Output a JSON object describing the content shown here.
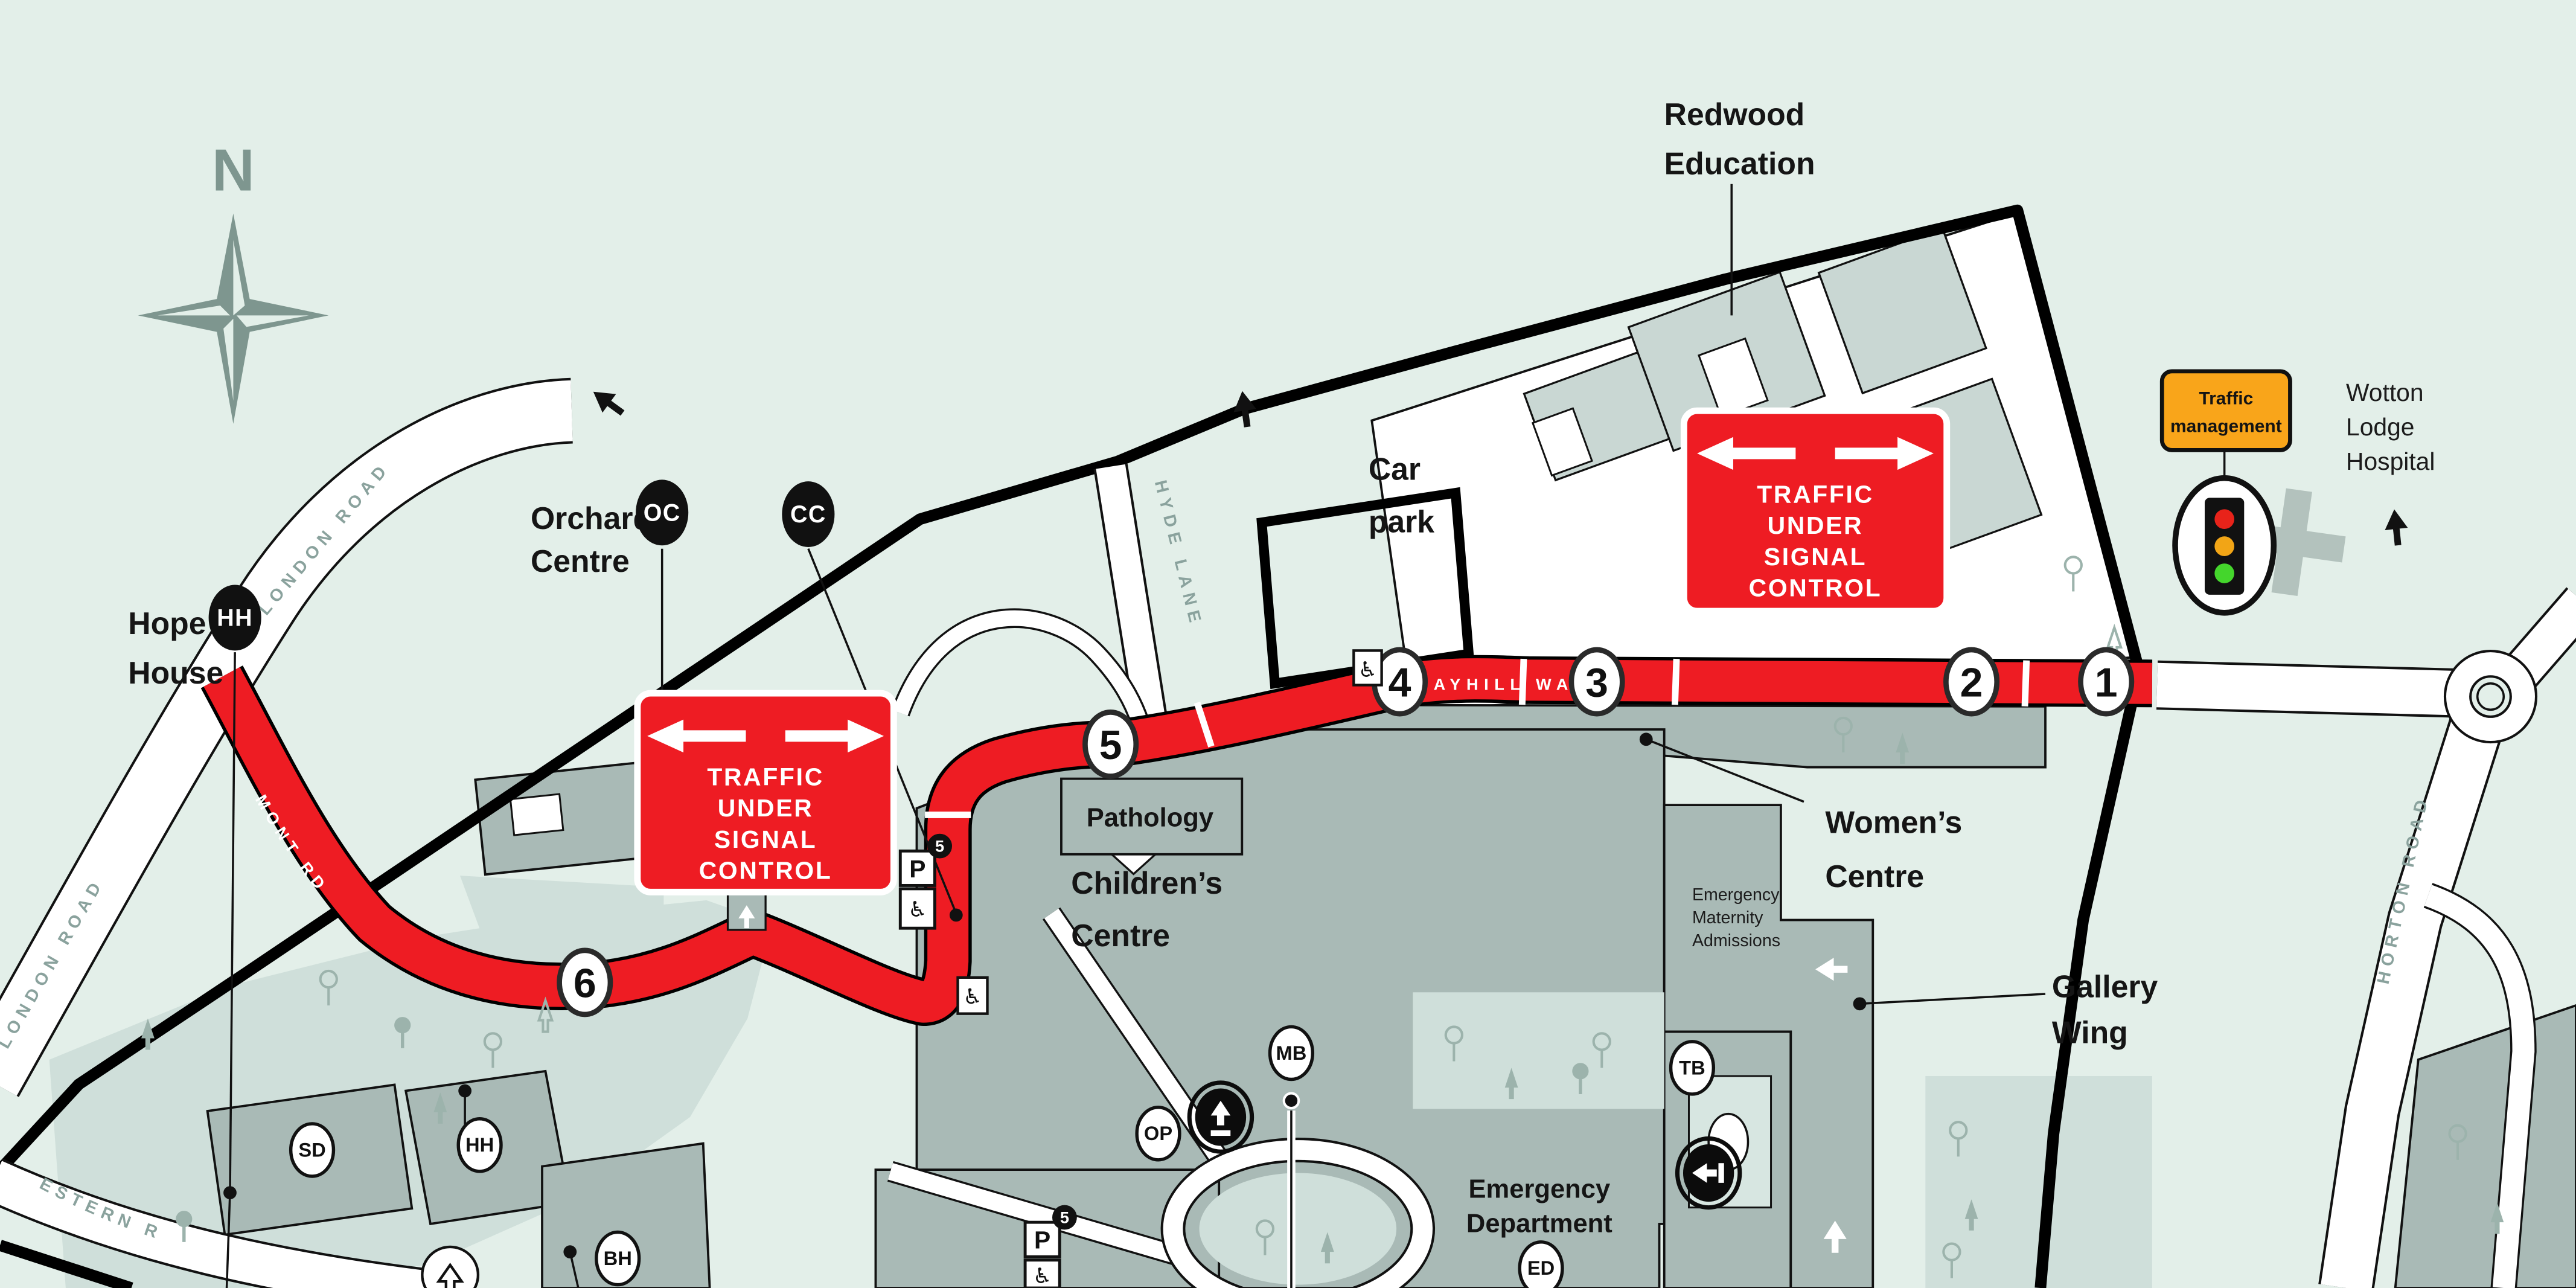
{
  "map": {
    "compass": {
      "north_label": "N"
    },
    "roads": {
      "london_road": "LONDON ROAD",
      "claremont_rd": "CLAREMONT RD",
      "mayhill_way": "MAYHILL WAY",
      "hyde_lane": "HYDE LANE",
      "horton_road": "HORTON ROAD",
      "great_western_road": "GREAT WESTERN R"
    },
    "route_stops": [
      "1",
      "2",
      "3",
      "4",
      "5",
      "6"
    ],
    "pins": {
      "oc": "OC",
      "cc": "CC",
      "hh": "HH"
    },
    "building_badges": {
      "sd": "SD",
      "hh": "HH",
      "bh": "BH",
      "op": "OP",
      "mb": "MB",
      "tb": "TB",
      "ed": "ED"
    },
    "signs": {
      "signal_control": {
        "lines": [
          "TRAFFIC",
          "UNDER",
          "SIGNAL",
          "CONTROL"
        ]
      },
      "traffic_management": {
        "lines": [
          "Traffic",
          "management"
        ]
      }
    },
    "labels": {
      "hope_house": [
        "Hope",
        "House"
      ],
      "orchard_centre": [
        "Orchard",
        "Centre"
      ],
      "redwood_education": [
        "Redwood",
        "Education"
      ],
      "car_park": [
        "Car",
        "park"
      ],
      "wotton_lodge_hospital": [
        "Wotton",
        "Lodge",
        "Hospital"
      ],
      "pathology": "Pathology",
      "childrens_centre": [
        "Children’s",
        "Centre"
      ],
      "womens_centre": [
        "Women’s",
        "Centre"
      ],
      "gallery_wing": [
        "Gallery",
        "Wing"
      ],
      "emergency_maternity": [
        "Emergency",
        "Maternity",
        "Admissions"
      ],
      "emergency_department": [
        "Emergency",
        "Department"
      ]
    },
    "parking": {
      "p": "P",
      "zone": "5"
    },
    "colors": {
      "background": "#e3efe9",
      "building_grey": "#a9bab6",
      "building_light_grey": "#c9d7d3",
      "grounds_green": "#cfdfda",
      "route_red": "#ee1c23",
      "traffic_management_orange": "#f9a51a",
      "boundary_black": "#000000",
      "road_white": "#ffffff",
      "road_label_grey": "#8aa29d",
      "signal_red": "#e8231a",
      "signal_amber": "#f2a516",
      "signal_green": "#44d62c"
    }
  }
}
